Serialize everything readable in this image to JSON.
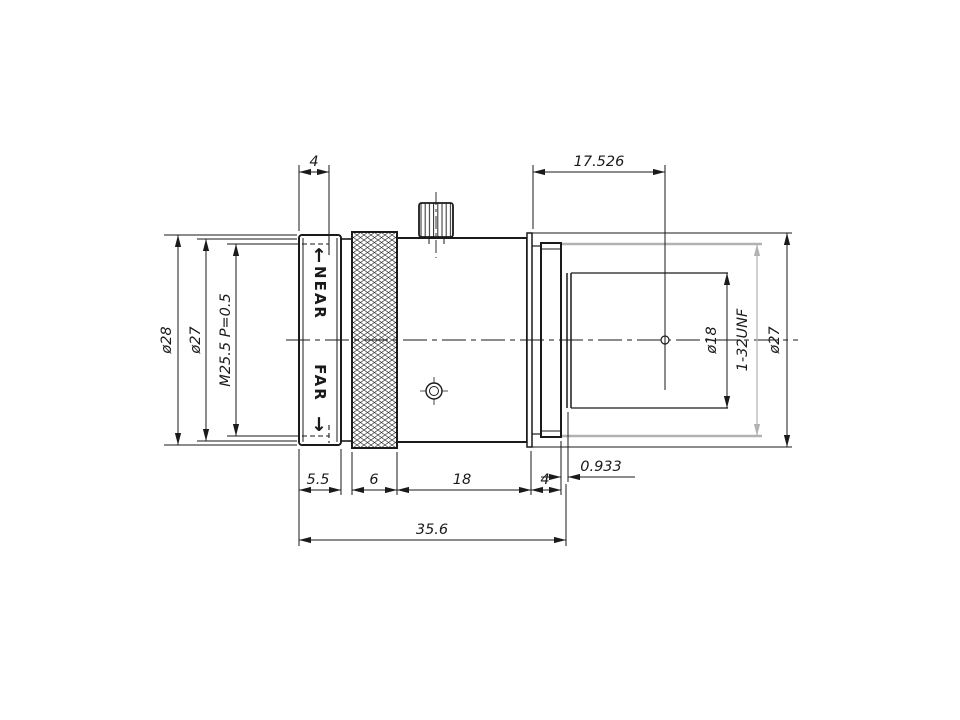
{
  "drawing": {
    "title": "c-mount-lens-dimension-drawing",
    "colors": {
      "line": "#1a1a1a",
      "thread_gray": "#b2b2b2",
      "label_navy": "#181a52",
      "arrow_blue": "#2543c9",
      "background": "#ffffff"
    },
    "dimensions": {
      "top": {
        "filter_thread_depth": "4",
        "flange_focal_distance": "17.526"
      },
      "left": {
        "outer_diameter": "ø28",
        "front_diameter": "ø27",
        "filter_thread": "M25.5 P=0.5"
      },
      "right": {
        "rear_barrel_diameter": "ø18",
        "mount_thread": "1-32UNF",
        "flange_diameter": "ø27"
      },
      "bottom": {
        "front_ring_length": "5.5",
        "knurl_length": "6",
        "body_length": "18",
        "flange_length": "4",
        "thread_relief": "0.933",
        "total_length": "35.6"
      }
    },
    "focus_ring": {
      "near_label": "NEAR",
      "far_label": "FAR",
      "near_arrow": "↑",
      "far_arrow": "↓"
    }
  }
}
